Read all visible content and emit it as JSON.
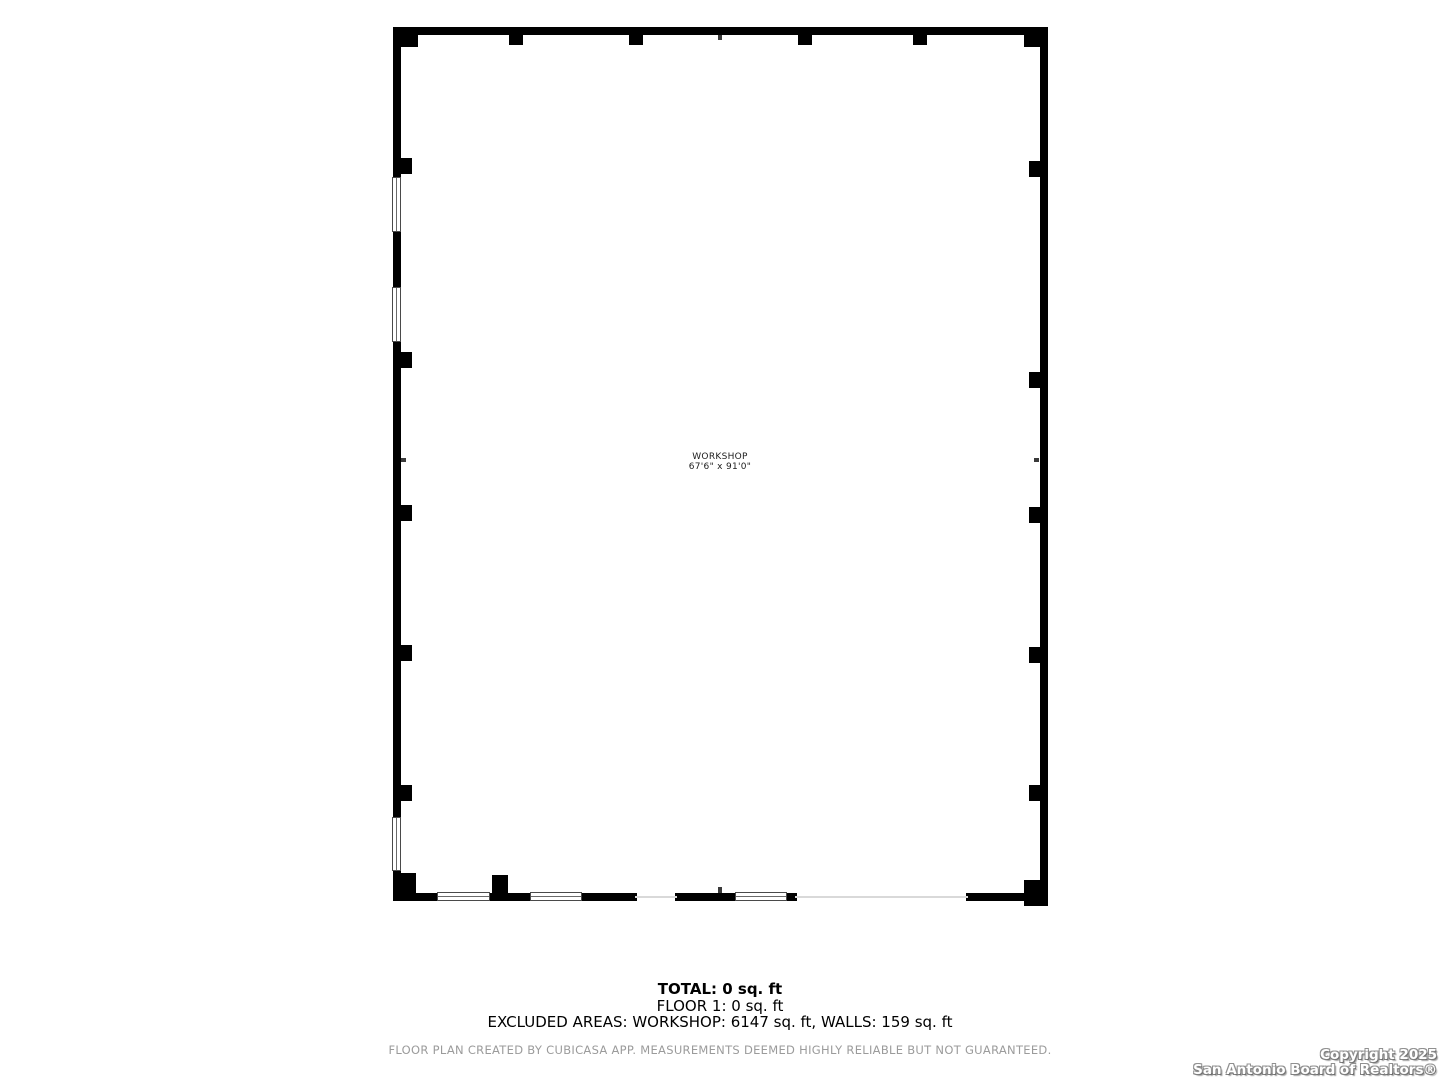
{
  "floor_plan": {
    "room": {
      "name": "WORKSHOP",
      "dimensions": "67'6\" x 91'0\""
    },
    "wall_color": "#000000",
    "window_outline_color": "#4a4a4a"
  },
  "summary": {
    "total": "TOTAL: 0 sq. ft",
    "floor": "FLOOR 1: 0 sq. ft",
    "excluded": "EXCLUDED AREAS: WORKSHOP: 6147 sq. ft, WALLS: 159 sq. ft"
  },
  "disclaimer": "FLOOR PLAN CREATED BY CUBICASA APP. MEASUREMENTS DEEMED HIGHLY RELIABLE BUT NOT GUARANTEED.",
  "watermark": {
    "line1": "Copyright 2025",
    "line2": "San Antonio Board of Realtors®"
  }
}
